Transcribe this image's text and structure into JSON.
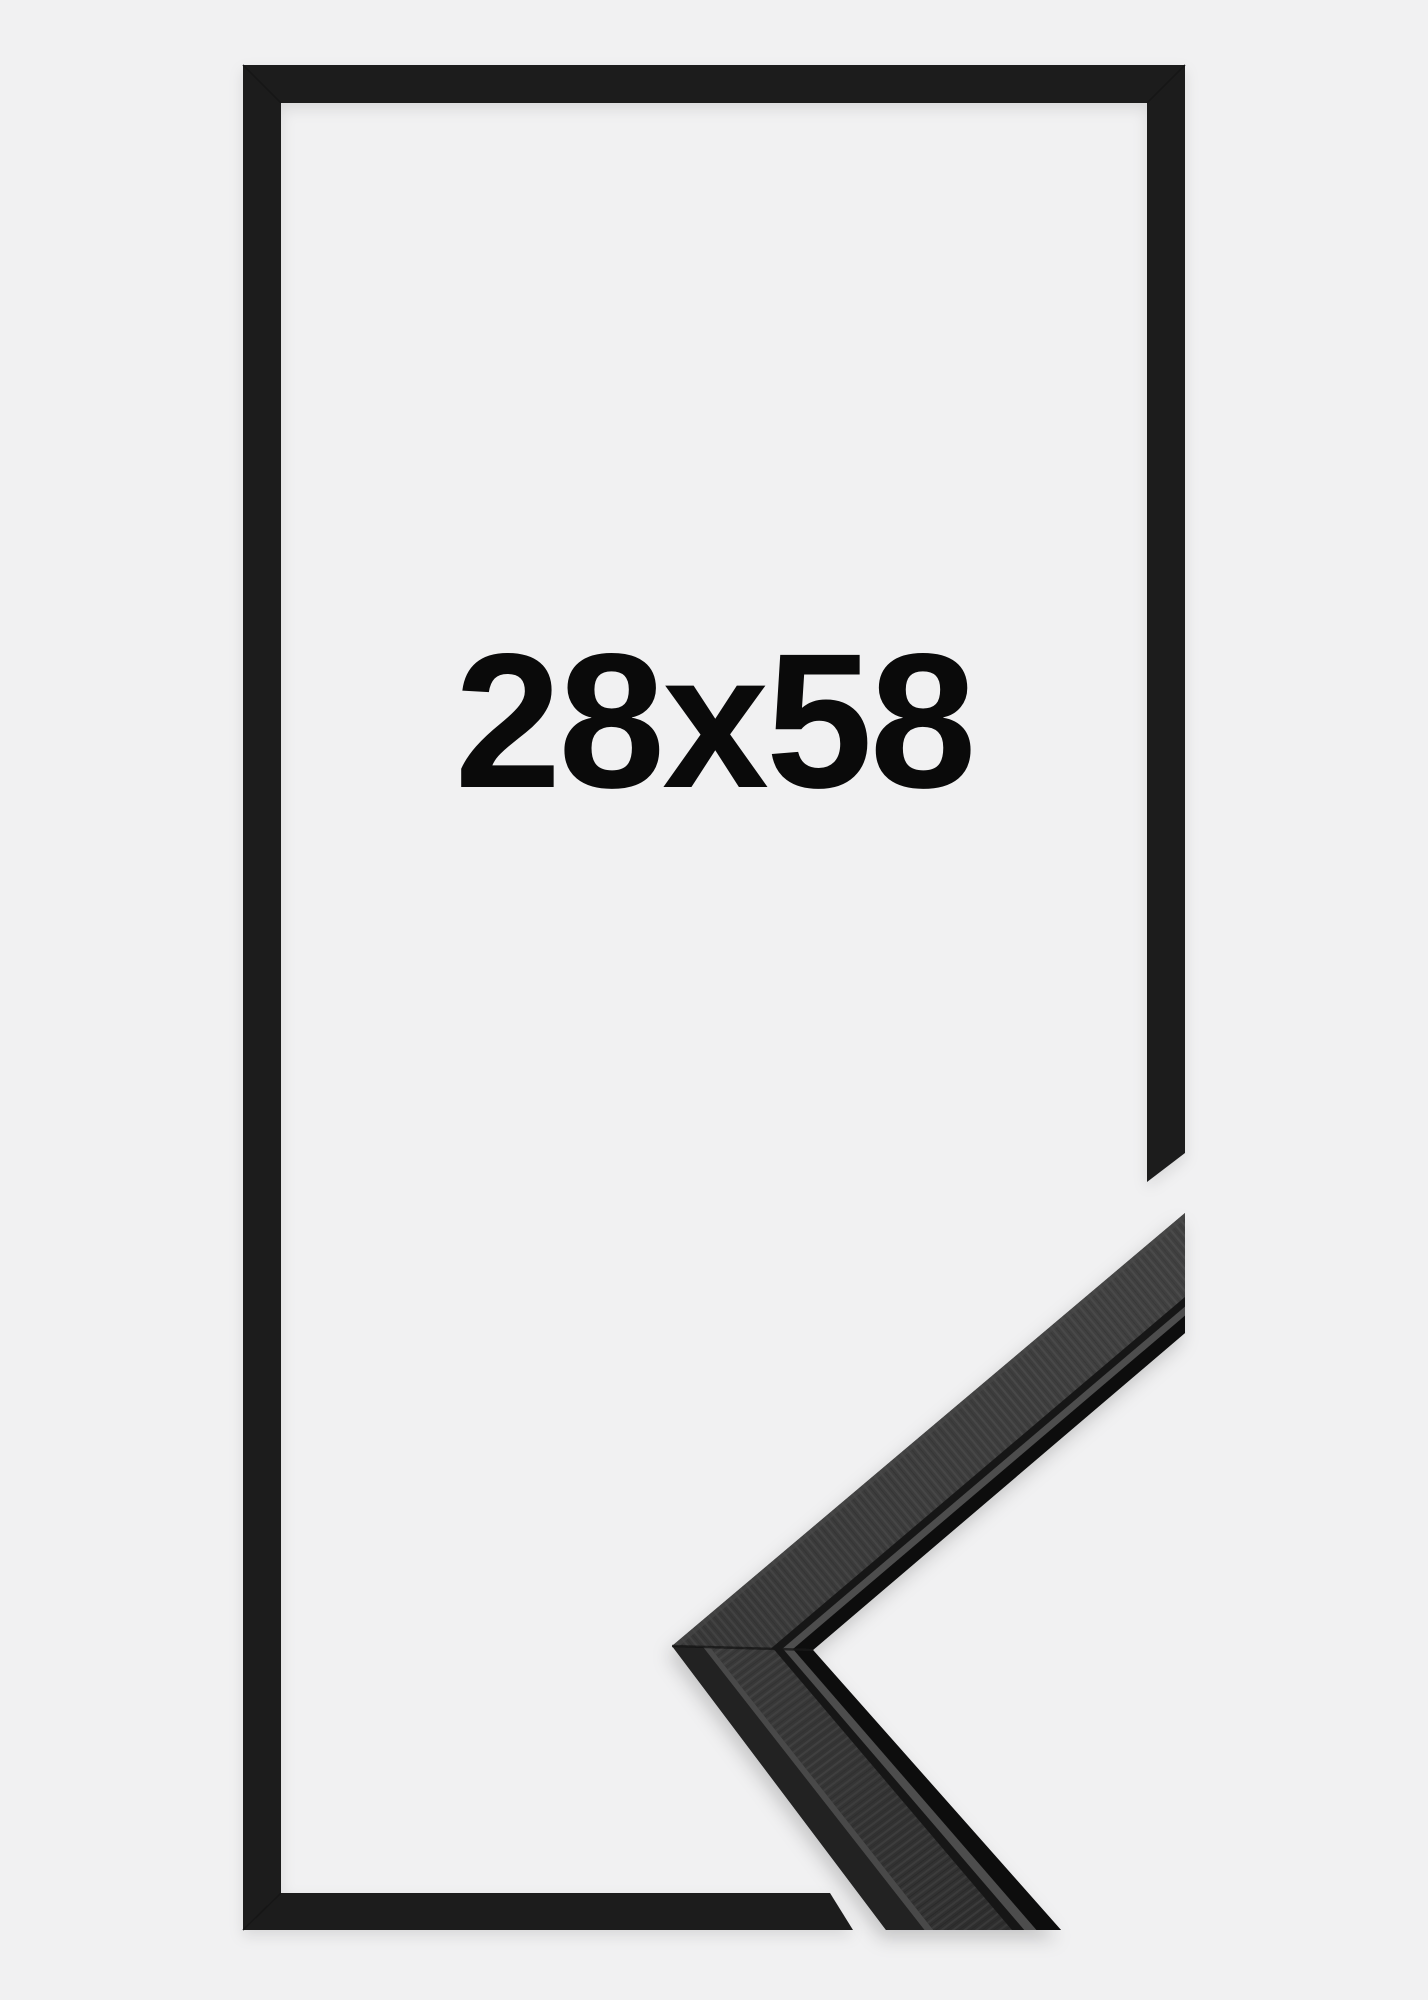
{
  "frame": {
    "size_label": "28x58",
    "colors": {
      "background": "#f1f1f2",
      "outline": "#1f1f1f",
      "outline-seam": "#151515",
      "label": "#0a0a0a",
      "sample-base": "#2c2c2c",
      "sample-face-upper-1": "#414141",
      "sample-face-upper-2": "#383838",
      "sample-face-lower-1": "#3a3a3a",
      "sample-face-lower-2": "#2e2e2e",
      "sample-highlight": "#474747",
      "sample-side": "#232323",
      "sample-arris": "#515151",
      "sample-groove": "#181818",
      "sample-lip": "#4d4d4d",
      "sample-edge": "#101010",
      "sample-seam": "#141414"
    }
  }
}
